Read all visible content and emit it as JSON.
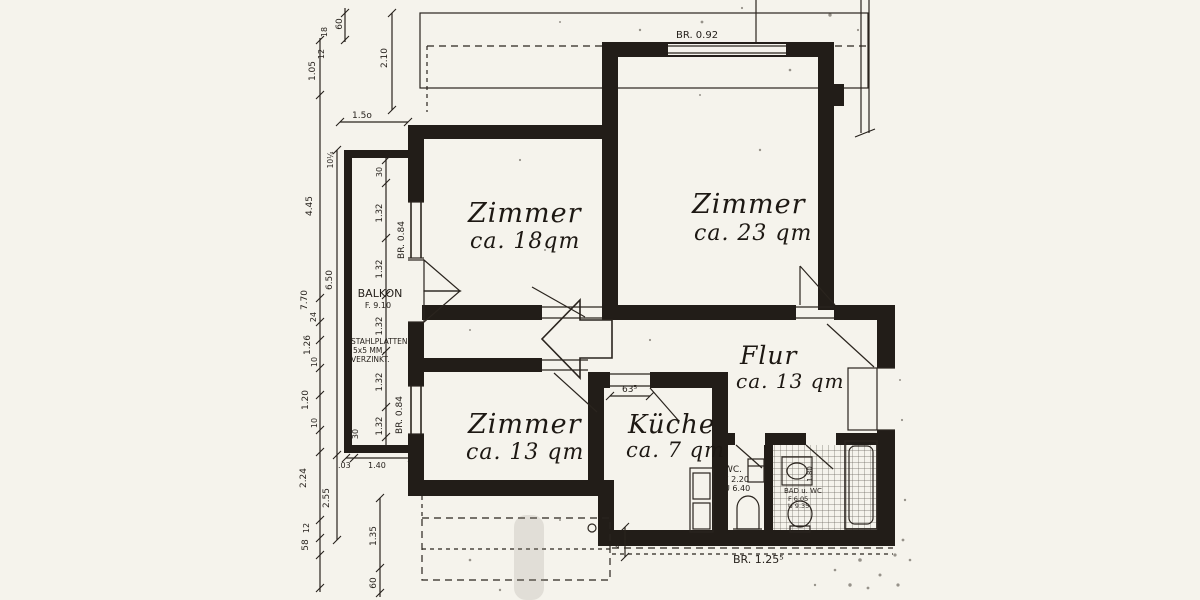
{
  "colors": {
    "paper": "#f5f3ec",
    "ink": "#221d18"
  },
  "rooms": [
    {
      "name": "Zimmer",
      "area": "ca. 18qm"
    },
    {
      "name": "Zimmer",
      "area": "ca. 23 qm"
    },
    {
      "name": "Zimmer",
      "area": "ca. 13 qm"
    },
    {
      "name": "Küche",
      "area": "ca. 7 qm"
    },
    {
      "name": "Flur",
      "area": "ca. 13 qm"
    }
  ],
  "balcony": {
    "name": "BALKON",
    "area": "F. 9.10",
    "note": [
      "STAHLPLATTEN,",
      "5x5 MM,",
      "VERZINKT."
    ]
  },
  "wc": {
    "lines": [
      "WC.",
      "F 2.20",
      "U 6.40"
    ]
  },
  "bad": {
    "lines": [
      "BAD u. WC",
      "F 6.05",
      "U 9.35"
    ],
    "dim": "1.80"
  },
  "parapets": {
    "top": "BR. 0.92",
    "balcony_upper": "BR. 0.84",
    "balcony_lower": "BR. 0.84",
    "bottom": "BR. 1.25⁵"
  },
  "doors": {
    "kitchen_width": "63⁵"
  },
  "dims": {
    "top": [
      "60",
      "18",
      "12",
      "1.05",
      "2.10",
      "1.5o",
      "10¼"
    ],
    "left": [
      "4.45",
      "6.50",
      "7.70",
      "24",
      "1.26",
      "10",
      "1.20",
      "10",
      "2.24",
      "2.55",
      "12",
      "58"
    ],
    "balcony": [
      "5",
      "30",
      "1.32",
      "1.32",
      "1.32",
      "1.32",
      "1.32",
      "30",
      ".03",
      "1.40"
    ],
    "bottom": [
      "1.35",
      "60",
      "40"
    ]
  }
}
